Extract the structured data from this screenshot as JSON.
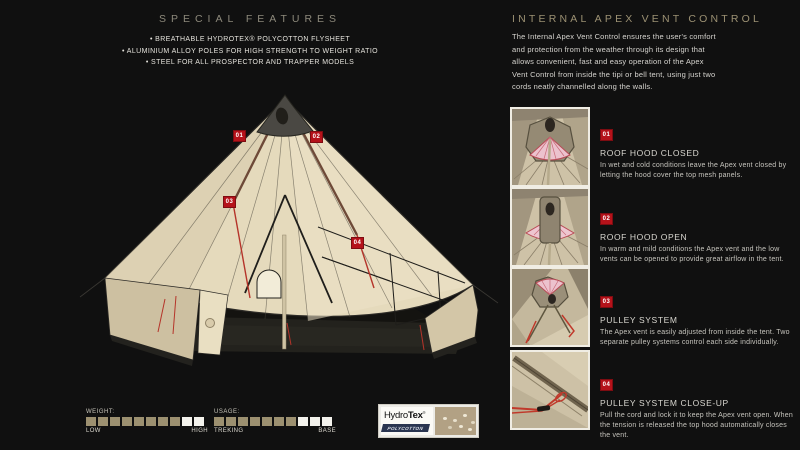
{
  "left": {
    "heading": "SPECIAL FEATURES",
    "bullets": [
      "BREATHABLE HYDROTEX® POLYCOTTON FLYSHEET",
      "ALUMINIUM ALLOY POLES FOR HIGH STRENGTH TO WEIGHT RATIO",
      "STEEL FOR ALL PROSPECTOR AND TRAPPER MODELS"
    ],
    "markers": {
      "m1": "01",
      "m2": "02",
      "m3": "03",
      "m4": "04"
    }
  },
  "scales": {
    "weight": {
      "label": "WEIGHT:",
      "low": "LOW",
      "high": "HIGH",
      "total": 10,
      "filled": 8
    },
    "usage": {
      "label": "USAGE:",
      "low": "TREKING",
      "high": "BASE",
      "total": 10,
      "filled": 7
    }
  },
  "logo": {
    "brand_a": "Hydro",
    "brand_b": "Tex",
    "registered": "®",
    "sub": "POLYCOTTON"
  },
  "right": {
    "heading": "INTERNAL APEX VENT CONTROL",
    "intro": "The Internal Apex Vent Control ensures the user's comfort and protection from the weather through its design that allows convenient, fast and easy operation of the Apex Vent Control from inside the tipi or bell tent, using just two cords neatly channelled along the walls.",
    "items": [
      {
        "num": "01",
        "title": "ROOF HOOD CLOSED",
        "body": "In wet and cold conditions leave the Apex vent closed by letting the hood cover the top mesh panels."
      },
      {
        "num": "02",
        "title": "ROOF HOOD OPEN",
        "body": "In warm and mild conditions the Apex vent and the low vents can be opened to provide great airflow in the tent."
      },
      {
        "num": "03",
        "title": "PULLEY SYSTEM",
        "body": "The Apex vent is easily adjusted from inside the tent. Two separate pulley systems control each side individually."
      },
      {
        "num": "04",
        "title": "PULLEY SYSTEM CLOSE-UP",
        "body": "Pull the cord and lock it to keep the Apex vent open. When the tension is released the top hood automatically closes the vent."
      }
    ]
  },
  "colors": {
    "accent_red": "#b5121a",
    "tan": "#9c9070",
    "canvas": "#e5dabc"
  }
}
